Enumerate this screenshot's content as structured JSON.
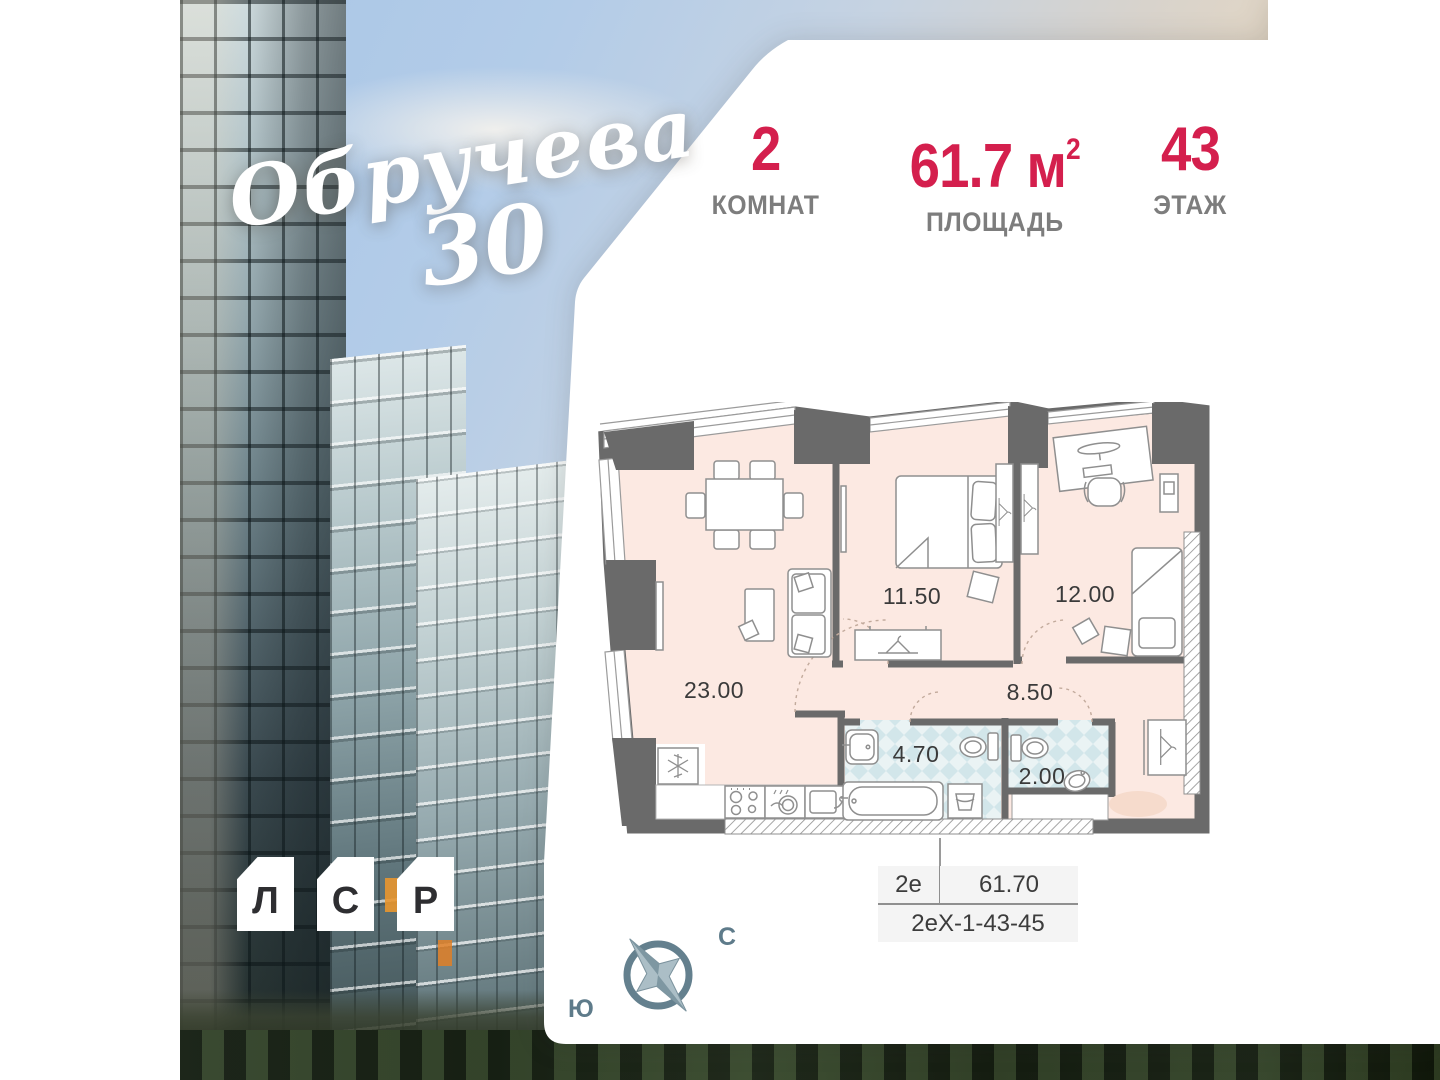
{
  "brand": {
    "logo_script": "Обручева",
    "logo_number": "30",
    "developer_letters": [
      "Л",
      "С",
      "Р"
    ]
  },
  "stats": {
    "rooms": {
      "value": "2",
      "label": "КОМНАТ"
    },
    "area": {
      "value": "61.7 м",
      "sup": "2",
      "label": "ПЛОЩАДЬ"
    },
    "floor": {
      "value": "43",
      "label": "ЭТАЖ"
    }
  },
  "plan": {
    "areas": {
      "living": "23.00",
      "bedroom1": "11.50",
      "bedroom2": "12.00",
      "hall": "8.50",
      "bathroom": "4.70",
      "wc": "2.00"
    }
  },
  "info_table": {
    "type": "2е",
    "area": "61.70",
    "code": "2еХ-1-43-45"
  },
  "compass": {
    "north": "С",
    "south": "Ю"
  },
  "colors": {
    "accent": "#d41f4d",
    "label_gray": "#7d7d7d",
    "wall": "#6a6a6a",
    "room_fill": "#fce9e2",
    "tile_fill": "#d9ebee",
    "compass": "#64808e"
  }
}
